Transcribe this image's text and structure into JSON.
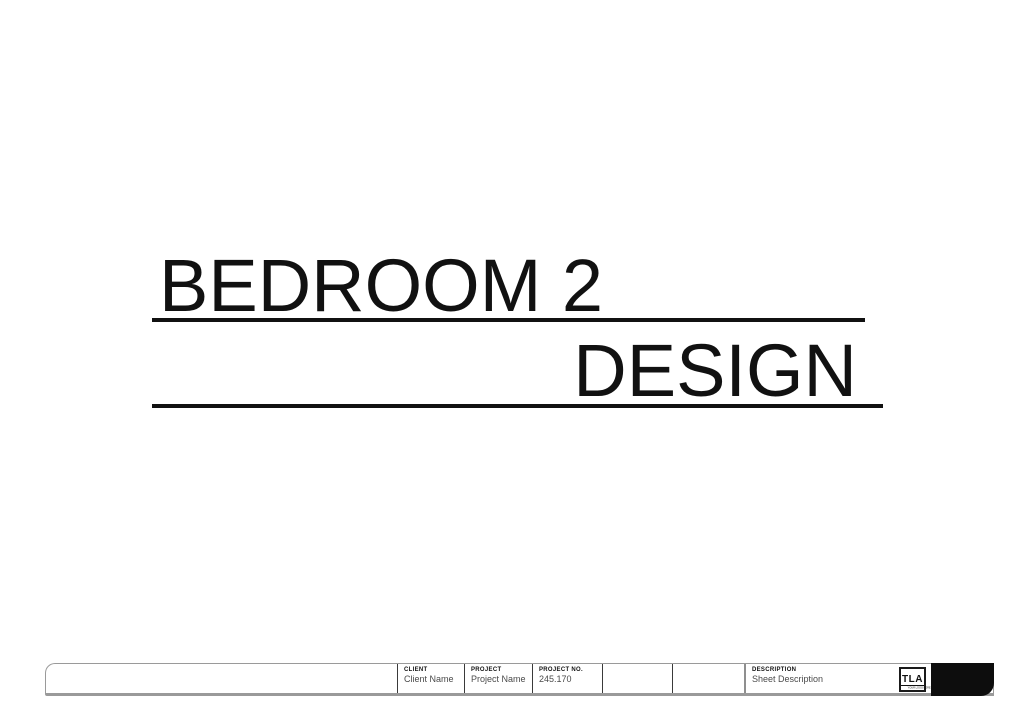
{
  "title": {
    "line1": "BEDROOM 2",
    "line2": "DESIGN"
  },
  "title_block": {
    "fields": [
      {
        "label": "CLIENT",
        "value": "Client Name"
      },
      {
        "label": "PROJECT",
        "value": "Project Name"
      },
      {
        "label": "PROJECT NO.",
        "value": "245.170"
      },
      {
        "label": "",
        "value": ""
      },
      {
        "label": "",
        "value": ""
      },
      {
        "label": "DESCRIPTION",
        "value": "Sheet Description"
      }
    ],
    "logo": {
      "acronym": "TLA",
      "tagline": "YOUR LOGO HERE"
    }
  },
  "colors": {
    "ink": "#111111",
    "band_border": "#9a9a9a",
    "endcap_black": "#0d0d0d",
    "value_text": "#4a4a4a"
  }
}
